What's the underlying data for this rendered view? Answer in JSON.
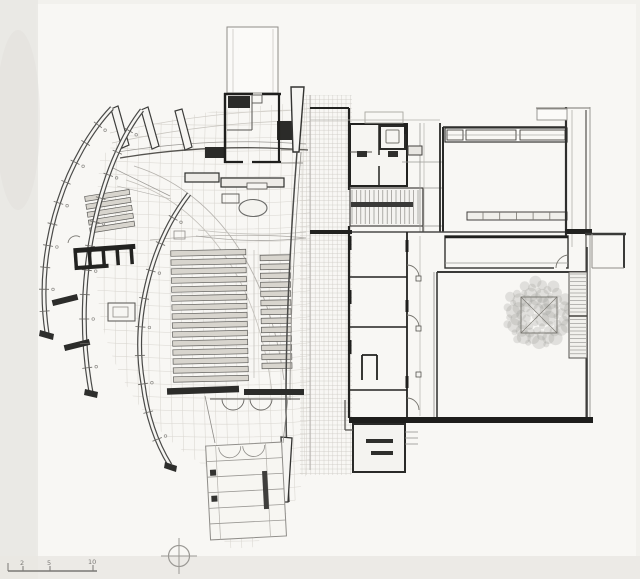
{
  "document": {
    "kind": "scanned architectural floor plan drawing",
    "content_summary": "church plan with four curved shell walls, nave pew seating, altar, bell tower, central spine corridor, community wing, courtyard with tree, stairs and entry ramp"
  },
  "scale_bar": {
    "tick_labels": [
      "2",
      "5",
      "10"
    ]
  },
  "north_indicator": {
    "symbol": "circle-with-crosshair"
  },
  "palette": {
    "paper": "#f2f1ed",
    "paper_light": "#f8f7f4",
    "paper_shadow": "#e7e5e1",
    "ink_dark": "#22221f",
    "ink_mid": "#55534f",
    "ink_light": "#8f8d89",
    "hatch": "#d9d6d0",
    "hatch_dense": "#cfccc6",
    "pew_fill": "#d8d5ce",
    "pew_line": "#5f5e5b",
    "tree": "#8e8c87"
  },
  "plan_features": {
    "pews": {
      "main_rows": 15,
      "right_rows": 13,
      "side_chapel_rows": 5
    },
    "stairs": {
      "mid_stair_treads": 16,
      "courtyard_stair_treads": 22,
      "entry_ramp_segments": 6
    },
    "shell_walls": 4,
    "tree_present": true
  }
}
